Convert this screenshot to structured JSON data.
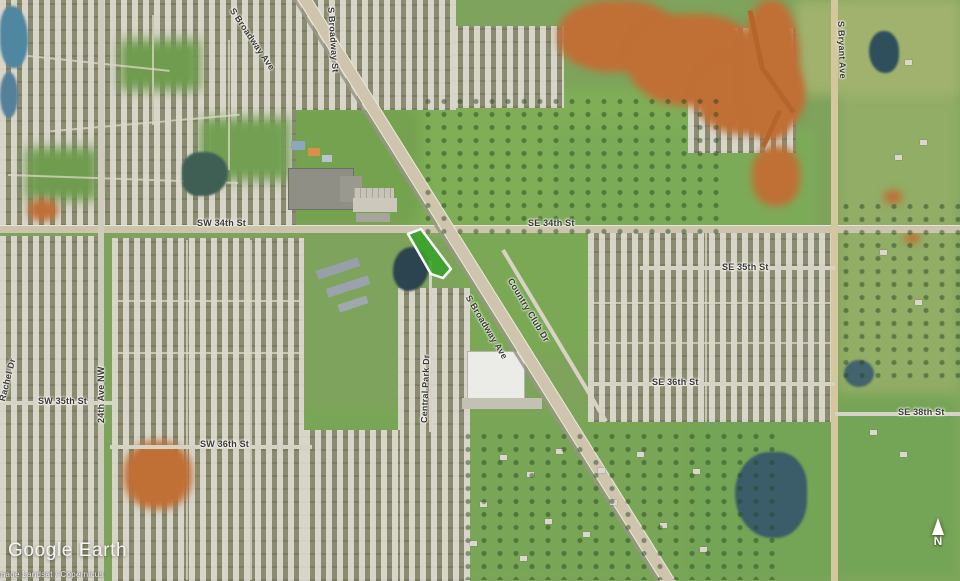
{
  "map": {
    "view": "satellite-aerial",
    "logo_text": "Google Earth",
    "attribution": "Image Landsat / Copernicus",
    "compass": {
      "label": "N"
    },
    "parcel": {
      "fill": "#3aa32a",
      "stroke": "#ffffff"
    }
  },
  "street_labels": [
    {
      "id": "s-broadway-ave-north",
      "text": "S Broadway Ave"
    },
    {
      "id": "s-broadway-st",
      "text": "S Broadway St"
    },
    {
      "id": "sw-34th-st",
      "text": "SW 34th St"
    },
    {
      "id": "se-34th-st",
      "text": "SE 34th St"
    },
    {
      "id": "se-35th-st",
      "text": "SE 35th St"
    },
    {
      "id": "country-club-dr",
      "text": "Country Club Dr"
    },
    {
      "id": "s-broadway-ave-south",
      "text": "S Broadway Ave"
    },
    {
      "id": "central-park-dr",
      "text": "Central Park Dr"
    },
    {
      "id": "24th-ave-nw",
      "text": "24th Ave NW"
    },
    {
      "id": "sw-35th-st",
      "text": "SW 35th St"
    },
    {
      "id": "sw-36th-st",
      "text": "SW 36th St"
    },
    {
      "id": "se-36th-st",
      "text": "SE 36th St"
    },
    {
      "id": "se-38th-st",
      "text": "SE 38th St"
    },
    {
      "id": "s-bryant-ave",
      "text": "S Bryant Ave"
    },
    {
      "id": "rachel-dr",
      "text": "Rachel Dr"
    }
  ]
}
